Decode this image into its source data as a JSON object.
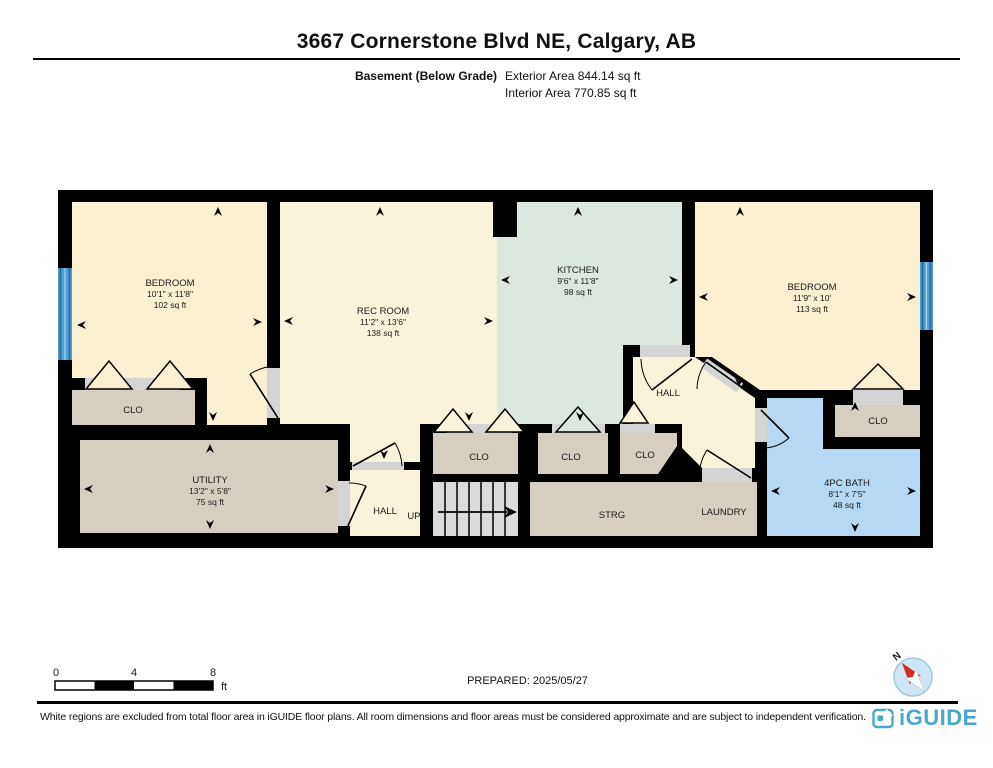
{
  "header": {
    "title": "3667 Cornerstone Blvd NE, Calgary, AB",
    "floor_label": "Basement (Below Grade)",
    "exterior_area": "Exterior Area 844.14 sq ft",
    "interior_area": "Interior Area 770.85 sq ft"
  },
  "rooms": {
    "bedroom_left": {
      "name": "BEDROOM",
      "dims": "10'1\" x 11'8\"",
      "area": "102 sq ft"
    },
    "rec_room": {
      "name": "REC ROOM",
      "dims": "11'2\" x 13'6\"",
      "area": "138 sq ft"
    },
    "kitchen": {
      "name": "KITCHEN",
      "dims": "9'6\" x 11'8\"",
      "area": "98 sq ft"
    },
    "bedroom_right": {
      "name": "BEDROOM",
      "dims": "11'9\" x 10'",
      "area": "113 sq ft"
    },
    "bath": {
      "name": "4PC BATH",
      "dims": "8'1\" x 7'5\"",
      "area": "48 sq ft"
    },
    "utility": {
      "name": "UTILITY",
      "dims": "13'2\" x 5'8\"",
      "area": "75 sq ft"
    },
    "hall_upper": "HALL",
    "hall_lower": "HALL",
    "up": "UP",
    "strg": "STRG",
    "laundry": "LAUNDRY",
    "closet_left": "CLO",
    "closet_a": "CLO",
    "closet_b": "CLO",
    "closet_c": "CLO",
    "closet_right": "CLO"
  },
  "scale_bar": {
    "t0": "0",
    "t4": "4",
    "t8": "8",
    "unit": "ft"
  },
  "prepared": "PREPARED: 2025/05/27",
  "compass": {
    "north": "N"
  },
  "footer": {
    "disclaimer": "White regions are excluded from total floor area in iGUIDE floor plans. All room dimensions and floor areas must be considered approximate and are subject to independent verification.",
    "brand": "iGUIDE"
  },
  "colors": {
    "wall": "#000000",
    "bedroom": "#FAEFD0",
    "rec_hall": "#FAF3DC",
    "kitchen": "#DCE8DF",
    "bath": "#B5D9F2",
    "storage": "#D7CEC2",
    "stairs": "#DBDBDB",
    "opening": "#D4D4D4",
    "window": "#4D9FD4",
    "brand_blue": "#47A8CC"
  }
}
